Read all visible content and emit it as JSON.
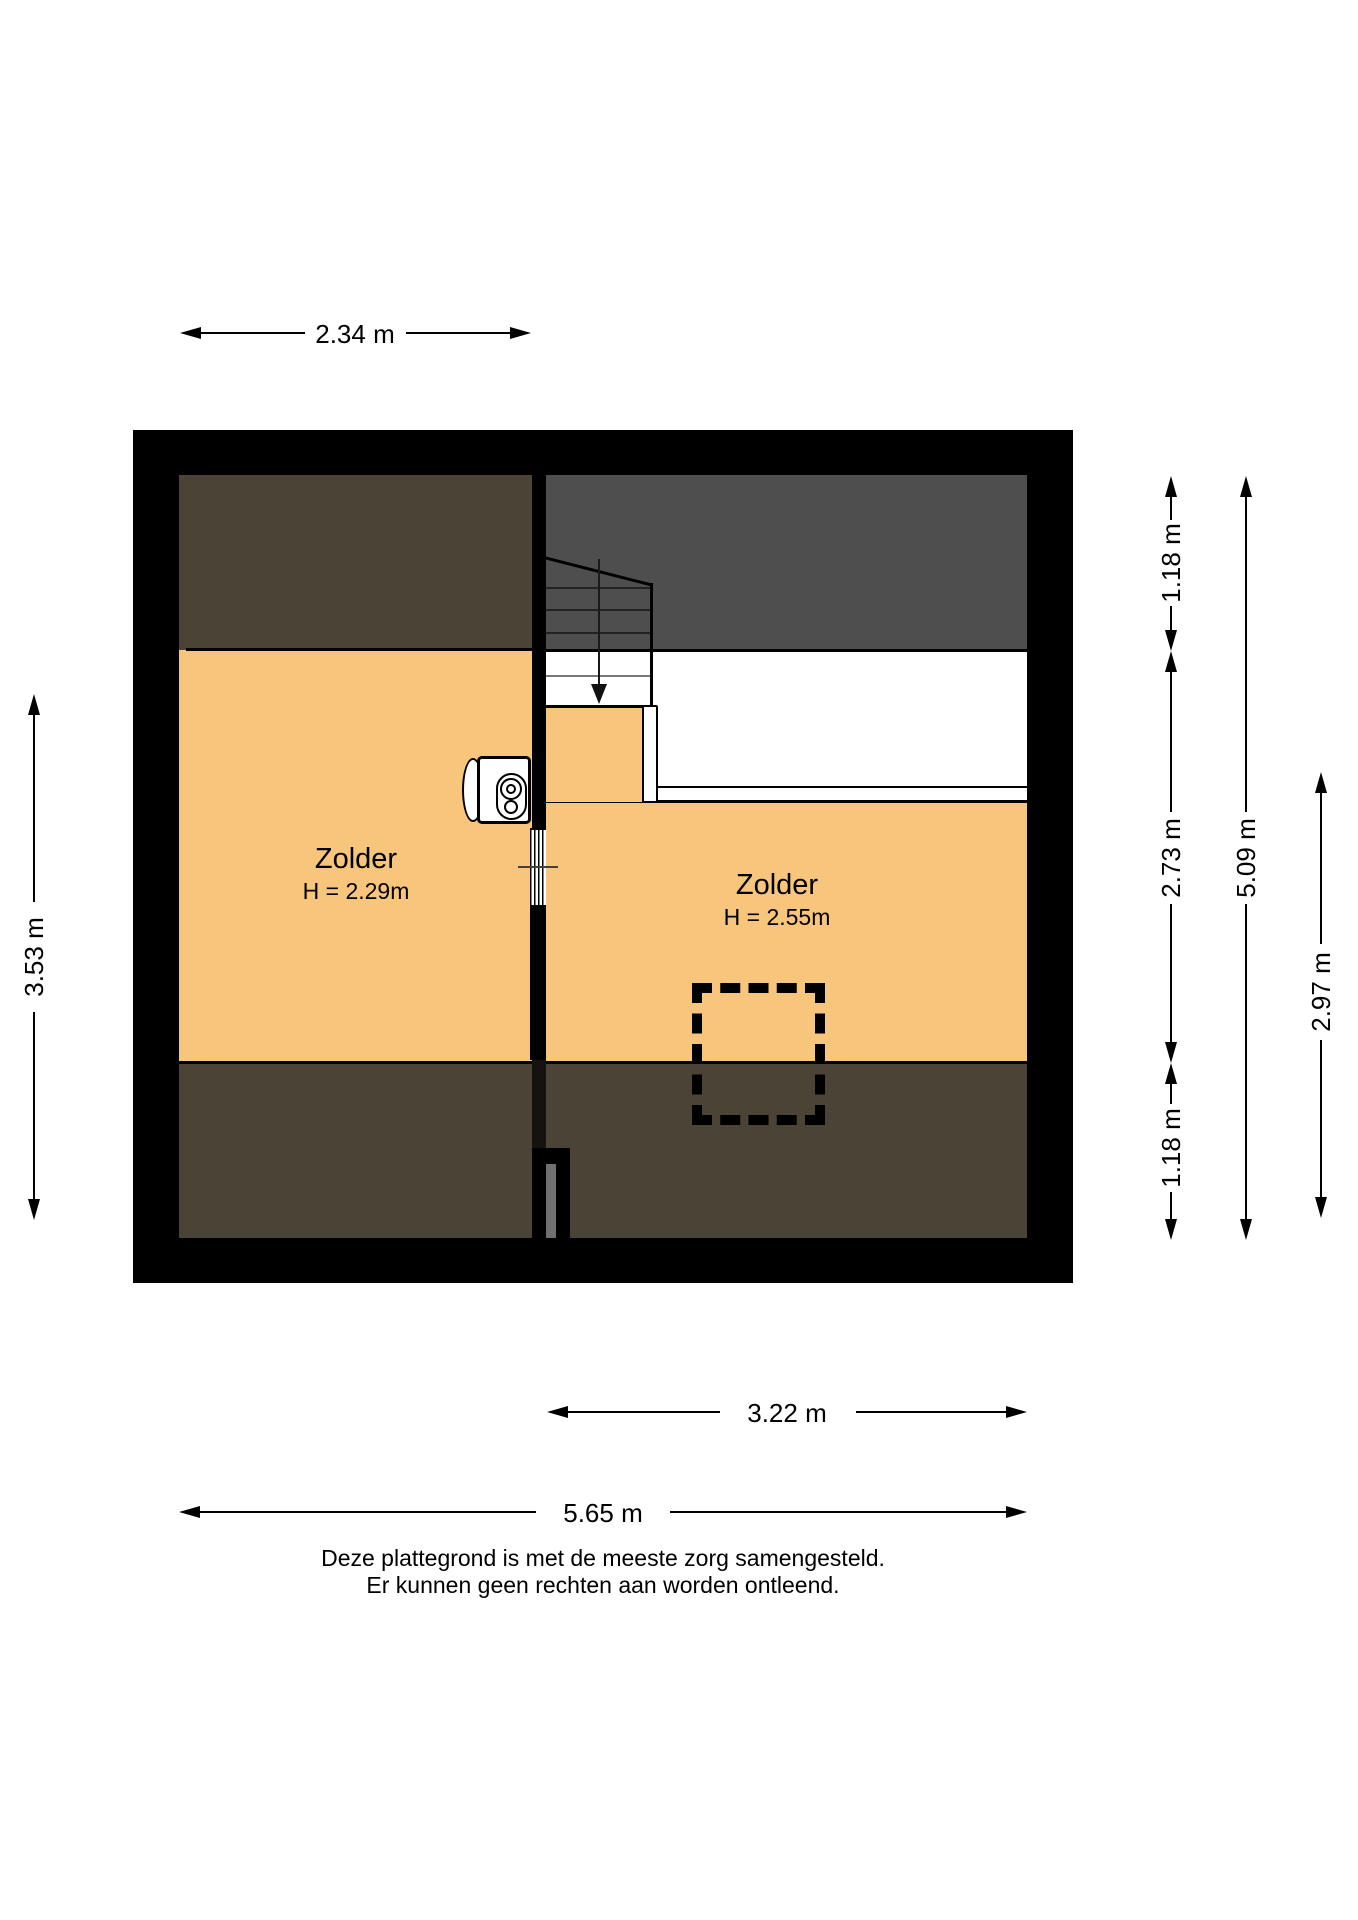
{
  "floorplan": {
    "rooms": [
      {
        "label": "Zolder",
        "height": "H = 2.29m"
      },
      {
        "label": "Zolder",
        "height": "H = 2.55m"
      }
    ],
    "dimensions": {
      "top_width": "2.34 m",
      "left_height": "3.53 m",
      "right_seg_top": "1.18 m",
      "right_seg_mid": "2.73 m",
      "right_seg_bottom": "1.18 m",
      "right_total": "5.09 m",
      "right_room": "2.97 m",
      "bottom_room": "3.22 m",
      "bottom_total": "5.65 m"
    },
    "disclaimer_line1": "Deze plattegrond is met de meeste zorg samengesteld.",
    "disclaimer_line2": "Er kunnen geen rechten aan worden ontleend.",
    "colors": {
      "wall": "#000000",
      "floor_orange": "#F7C57C",
      "roof_slope_brown": "#4A4336",
      "roof_slope_gray": "#4E4E4E",
      "void_white": "#FFFFFF",
      "duct_gray": "#707070"
    }
  }
}
